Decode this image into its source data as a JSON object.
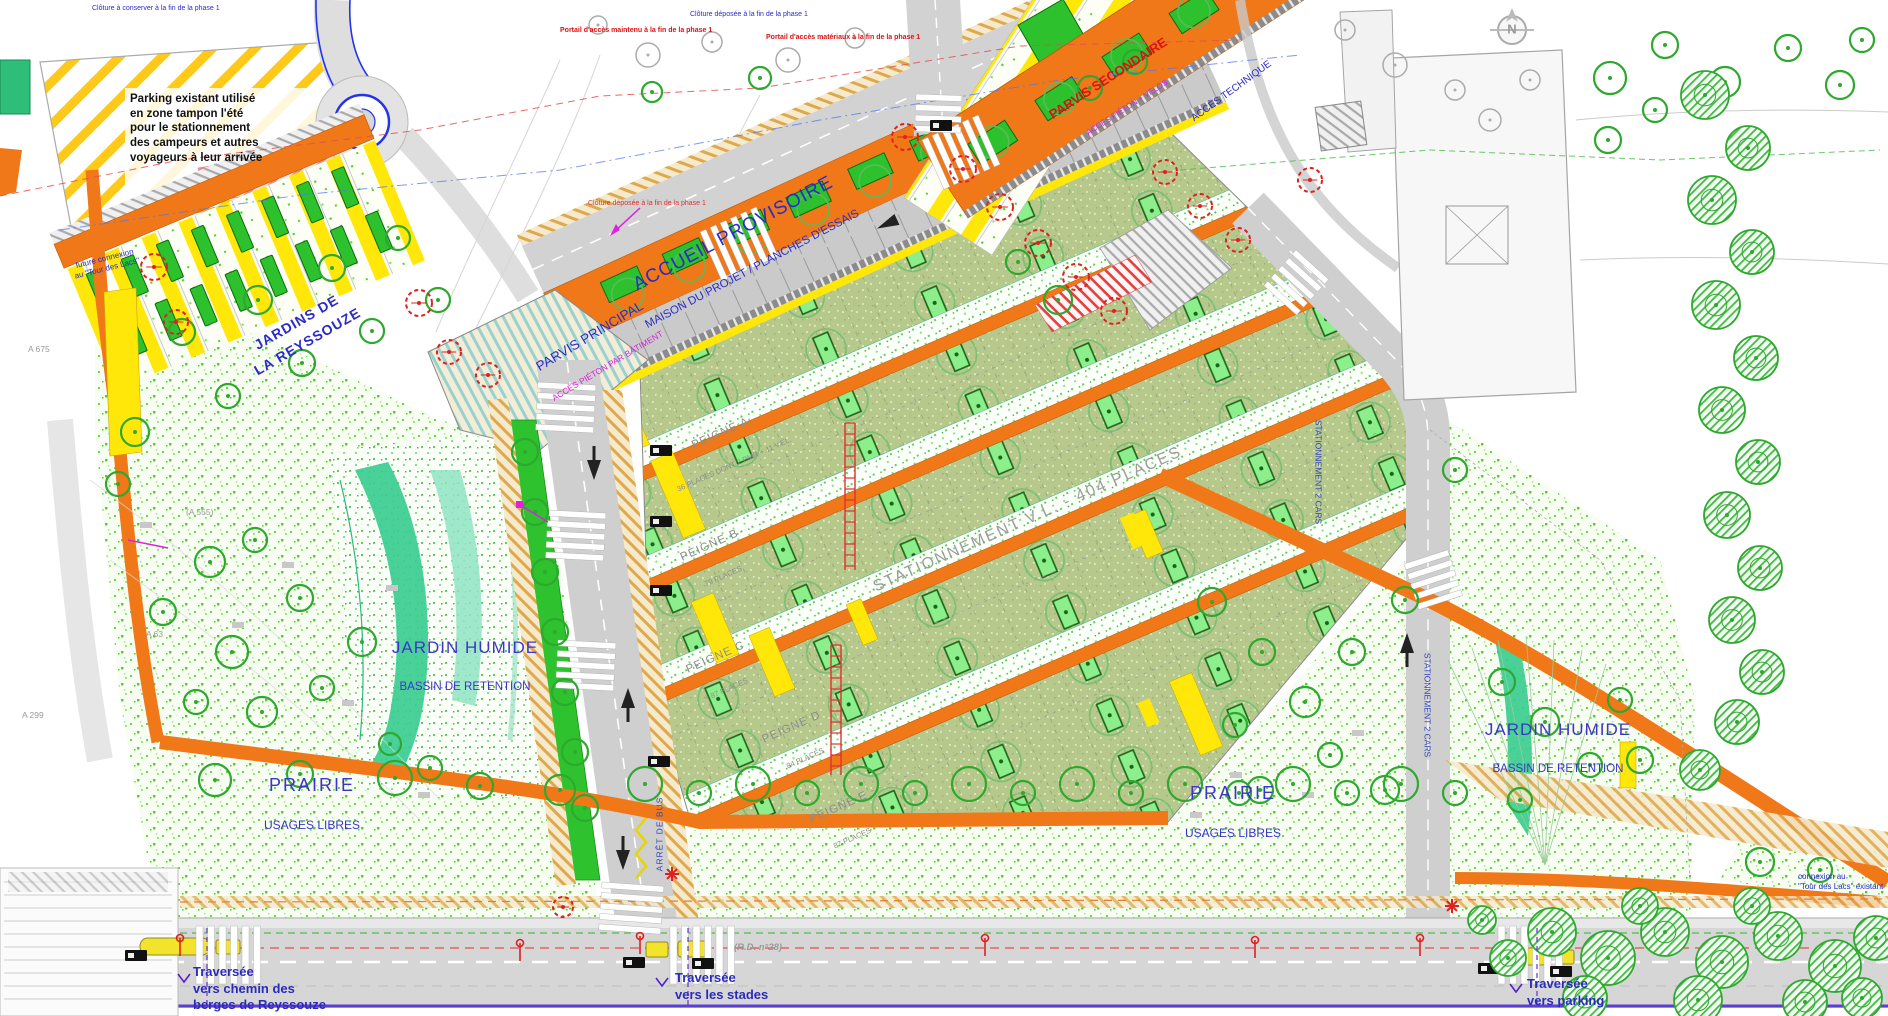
{
  "colors": {
    "path_orange": "#F07818",
    "path_yellow": "#FFE70A",
    "parking_olive": "#B7C88D",
    "planter_green": "#2DC22D",
    "wet_garden_teal": "#3ACD90",
    "road_grey": "#D2D2D2",
    "label_blue": "#2B2BC8",
    "label_violet": "#3C35C8",
    "label_red": "#E01010",
    "label_magenta": "#D81ED8",
    "label_grey": "#9C9C9C"
  },
  "labels": {
    "parking_note": "Parking existant utilisé\nen zone tampon l'été\npour le stationnement\ndes campeurs et autres\nvoyageurs à leur arrivée",
    "jardins": "JARDINS DE\nLA REYSSOUZE",
    "accueil_title": "ACCUEIL PROVISOIRE",
    "accueil_sub": "MAISON DU PROJET / PLANCHES D'ESSAIS",
    "parvis_principal": "PARVIS PRINCIPAL",
    "parvis_principal_sub": "ACCÈS PIÉTON PAR BÂTIMENT",
    "parvis_secondaire": "PARVIS SECONDAIRE",
    "parvis_secondaire_sub": "ACCÈS PIÉTON + VÉLOS",
    "acces_technique": "ACCÈS TECHNIQUE",
    "stationnement_vl": "STATIONNEMENT V.L. - 404 PLACES",
    "peigne_a": "PEIGNE A",
    "peigne_a_sub": "36 PLACES DONT 2 PMR + 11 V.ÉL.",
    "peigne_b": "PEIGNE B",
    "peigne_b_sub": "79 PLACES",
    "peigne_c": "PEIGNE C",
    "peigne_c_sub": "87 PLACES",
    "peigne_d": "PEIGNE D",
    "peigne_d_sub": "84 PLACES",
    "peigne_e": "PEIGNE E",
    "peigne_e_sub": "87 PLACES",
    "jardin_humide": "JARDIN HUMIDE",
    "bassin": "BASSIN DE RETENTION",
    "prairie": "PRAIRIE",
    "usages_libres": "USAGES LIBRES",
    "traversee_berges": "Traversée\nvers chemin des\nberges de Reyssouze",
    "traversee_stades": "Traversée\nvers les stades",
    "traversee_parking": "Traversée\nvers parking",
    "connexion_lacs": "connexion au\n\"Tour des Lacs\" existant",
    "future_connexion": "future connexion\nau \"Tour des Lacs\"",
    "arret_bus": "ARRÊT DE BUS",
    "stationnement_cars": "STATIONNEMENT 2 CARS",
    "rd_road": "(R.D. n°28)",
    "cloture_conserver": "Clôture à conserver à la fin de la phase 1",
    "cloture_deposee": "Clôture déposée à la fin de la phase 1",
    "portail_maintenu": "Portail d'accès maintenu à la fin de la phase 1",
    "portail_materiaux": "Portail d'accès matériaux à la fin de la phase 1",
    "elev_a675": "A 675",
    "elev_a555": "(A 555)",
    "elev_a63": "A 63",
    "elev_a299": "A 299",
    "north": "N"
  }
}
